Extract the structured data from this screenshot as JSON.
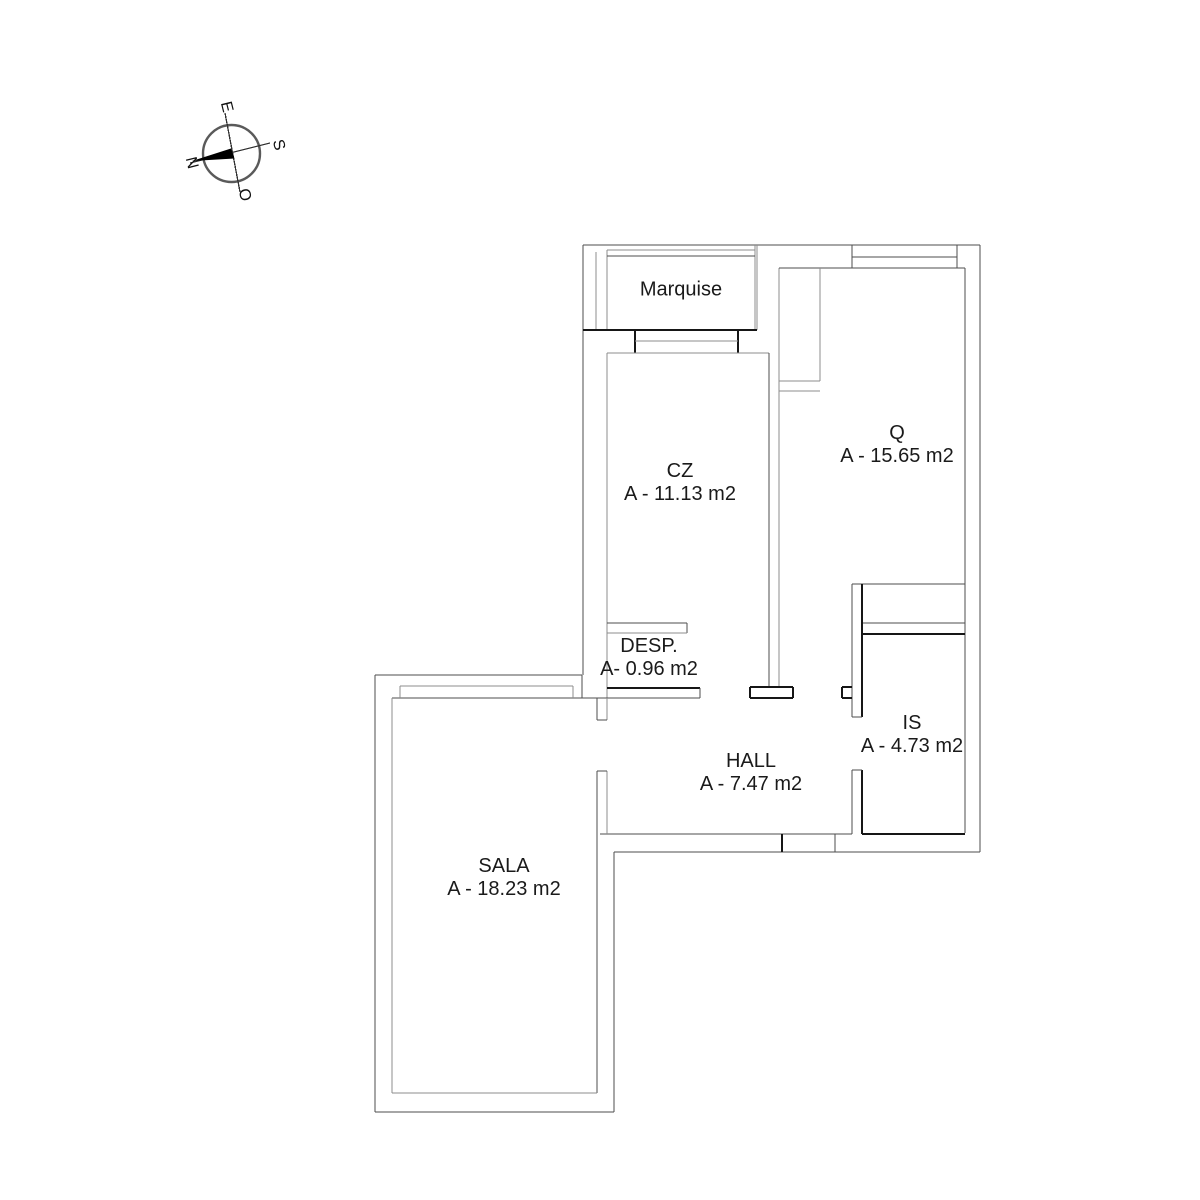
{
  "title": "Apartment floor plan",
  "compass": {
    "north": "N",
    "south": "S",
    "east": "E",
    "west": "O"
  },
  "rooms": [
    {
      "id": "marquise",
      "name": "Marquise",
      "area": ""
    },
    {
      "id": "cz",
      "name": "CZ",
      "area": "A - 11.13 m2"
    },
    {
      "id": "q",
      "name": "Q",
      "area": "A - 15.65 m2"
    },
    {
      "id": "desp",
      "name": "DESP.",
      "area": "A- 0.96 m2"
    },
    {
      "id": "is",
      "name": "IS",
      "area": "A - 4.73 m2"
    },
    {
      "id": "hall",
      "name": "HALL",
      "area": "A - 7.47 m2"
    },
    {
      "id": "sala",
      "name": "SALA",
      "area": "A - 18.23 m2"
    }
  ]
}
